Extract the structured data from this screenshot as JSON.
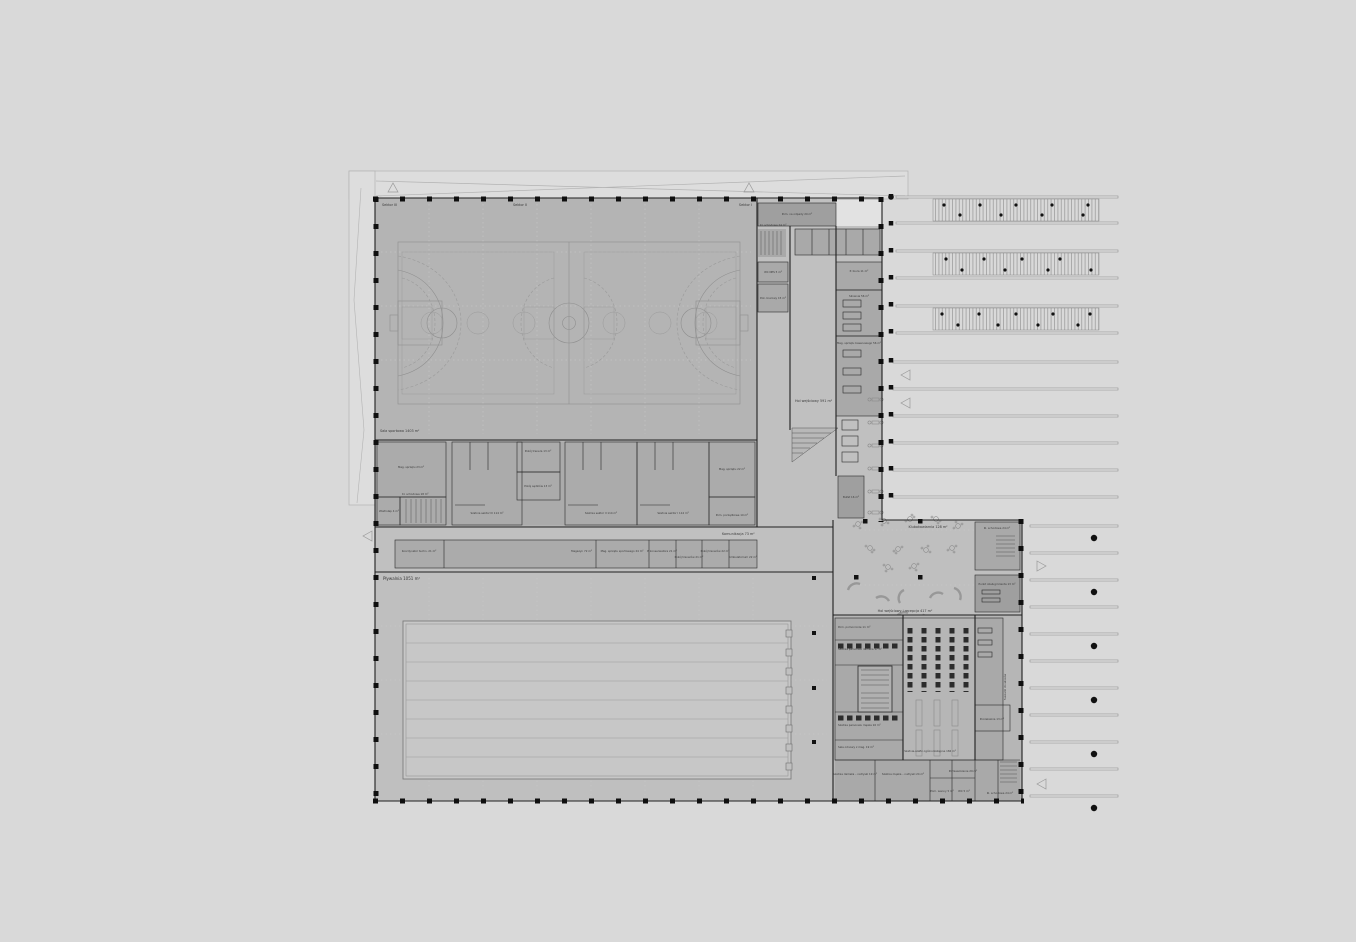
{
  "drawing": {
    "type": "architectural-floor-plan",
    "subject": "sports centre ground floor — sports hall, swimming pool, entrance foyer, changing rooms",
    "colors": {
      "background": "#d9d9d9",
      "floor": "#bdbdbd",
      "room": "#a9a9a9",
      "wall": "#1f1f1f",
      "courtline": "#8f8f8f"
    },
    "labels": {
      "sector1": "Sektor I",
      "sector2": "Sektor II",
      "sector3": "Sektor III",
      "sportsHall": "Sala sportowa 1403 m²",
      "pool": "Pływalnia 1051 m²",
      "foyer": "Hol wejściowy 591 m²",
      "foyerReception": "Hol wejściowy i recepcja 417 m²",
      "cafe": "Klubokawiarnia 128 m²",
      "corridor": "Komunikacja 73 m²",
      "magEquip23": "Mag. sprzętu 23 m²",
      "lockerS3": "Szatnia sektor III 114 m²",
      "coachRoom": "Pokój trenera 13 m²",
      "refereesRoom": "Pokój sędziów 13 m²",
      "lockerS2": "Szatnia sektor II 114 m²",
      "lockerS1": "Szatnia sektor I 114 m²",
      "magEquip22": "Mag. sprzętu 22 m²",
      "cleaningRoom": "Pom. porządkowe 10 m²",
      "vestibule": "Wiatrołap 4 m²",
      "stairA": "Kl. schodowa 18 m²",
      "coordinator": "Koordynator techn. 21 m²",
      "storage72": "Magazyn 72 m²",
      "sportStorage24": "Mag. sprzętu sportowego 24 m²",
      "maintenance": "P. konserwatora 21 m²",
      "coaches21": "Pokój trenerów 21 m²",
      "coaches22": "Pokój trenerów 22 m²",
      "ambulatory": "Ambulatorium 22 m²",
      "wasteRoom": "Pom. na odpady 20 m²",
      "stairB": "Kl. schodowa 24 m²",
      "wcNps": "WC NPS 5 m²",
      "office15": "Pok. biurowy 15 m²",
      "office11": "P. biura 11 m²",
      "gym56": "Siłownia 56 m²",
      "poolStorage56": "Mag. sprzętu basenowego 56 m²",
      "buffet": "Bufet 16 m²",
      "stairC": "Kl. schodowa 24 m²",
      "serviceDesk": "Punkt obsługi klienta 13 m²",
      "auxRoom": "Pom. pomocnicze 11 m²",
      "staffLockerF": "Szatnia personelu damska 17 m²",
      "staffLockerM": "Szatnia personelu męska 16 m²",
      "recoveryRoom": "Sala odnowy z mag. 19 m²",
      "publicLockers": "Szatnia-szafki ogólnodostępne 184 m²",
      "waitingRoom": "Poczekalnia 13 m²",
      "hairDryers": "Suszarki do włosów",
      "showersF": "Szatnia damska – natryski 19 m²",
      "showersM": "Szatnia męska – natryski 24 m²",
      "room29": "Pomieszczenie 29 m²",
      "tubRoom": "Pom. wanny 5 m²",
      "wc5": "WC 5 m²",
      "stairD": "Kl. schodowa 24 m²"
    }
  }
}
